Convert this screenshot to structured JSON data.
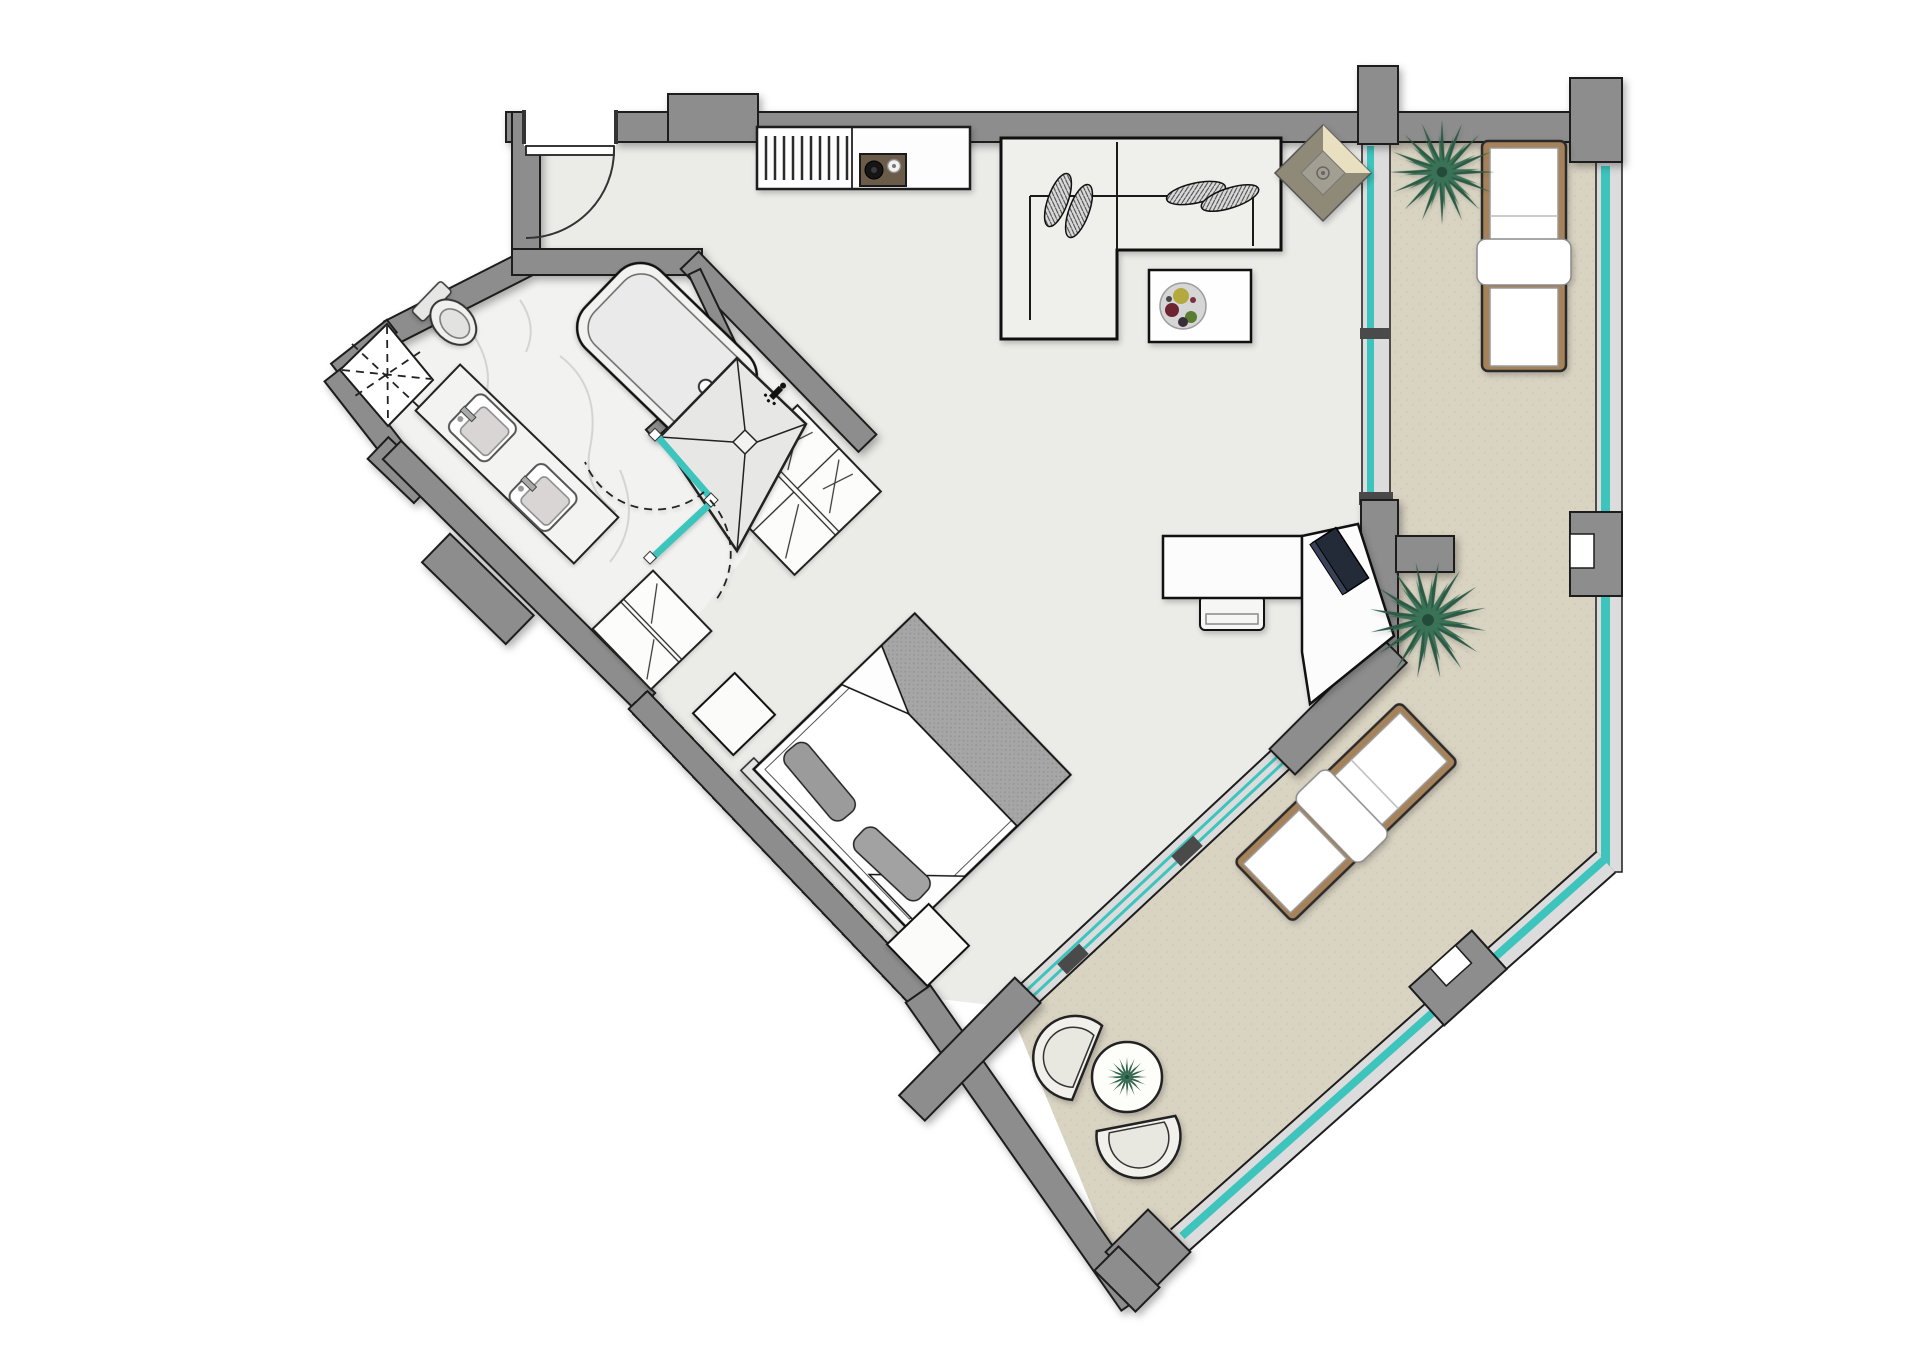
{
  "canvas": {
    "width": 1920,
    "height": 1358
  },
  "colors": {
    "page_bg": "#ffffff",
    "wall": "#8d8d8d",
    "line": "#1d1d1d",
    "floor_interior": "#ebebe8",
    "floor_balcony": "#d9d3c2",
    "marble": "#f2f2f1",
    "shower_tile": "#e7e7e6",
    "teal_glass": "#3cc4bd",
    "glass_band": "#dcdcdc",
    "mullion": "#4a4a4a",
    "furniture_white": "#fcfcfb",
    "sofa_fill": "#efefec",
    "lounger_frame": "#a5825a",
    "cooktop_brown": "#6a5c49",
    "plant_green_dark": "#2c5a45",
    "plant_green_mid": "#3a7258",
    "blanket_gray": "#a6a6a6",
    "pillow_gray": "#9b9b9b",
    "diamond_body": "#8f8a77",
    "diamond_bevel": "#e9e0c2"
  },
  "legend": {
    "plan": "studio-apartment-floor-plan",
    "living_area": "open-living-kitchen-area",
    "bathroom": "marble-bathroom",
    "bedroom": "bedroom-area",
    "balcony": "wrap-around-balcony-terrace",
    "shaft": "service-shaft-void",
    "entry_door": "entry-swing-door",
    "kitchen_counter": "kitchen-counter-with-cooktop",
    "sofa": "l-shaped-sofa-sectional",
    "coffee_table": "coffee-table-with-fruit-plate",
    "diamond_decor": "diamond-decor-table",
    "desk": "corner-work-desk-with-laptop",
    "bed": "double-bed-with-blanket-and-pillows",
    "wardrobe_large": "hatched-wardrobe-large",
    "wardrobe_small": "hatched-wardrobe-small",
    "nightstand": "bedside-table",
    "bathtub": "oval-bathtub",
    "toilet": "toilet",
    "vanity": "double-sink-vanity",
    "shower": "corner-shower-with-glass-door",
    "sun_lounger": "sun-lounger",
    "outdoor_set": "outdoor-chairs-and-round-table",
    "plant": "potted-palm-plant",
    "glazing": "teal-glass-curtain-wall"
  },
  "inventory": {
    "plants": 3,
    "sun_loungers": 2,
    "outdoor_chairs": 2,
    "vanity_sinks": 2,
    "sofa_pillows": 4,
    "wardrobes": 2,
    "nightstands": 2,
    "glass_door_panels_teal": 2
  }
}
